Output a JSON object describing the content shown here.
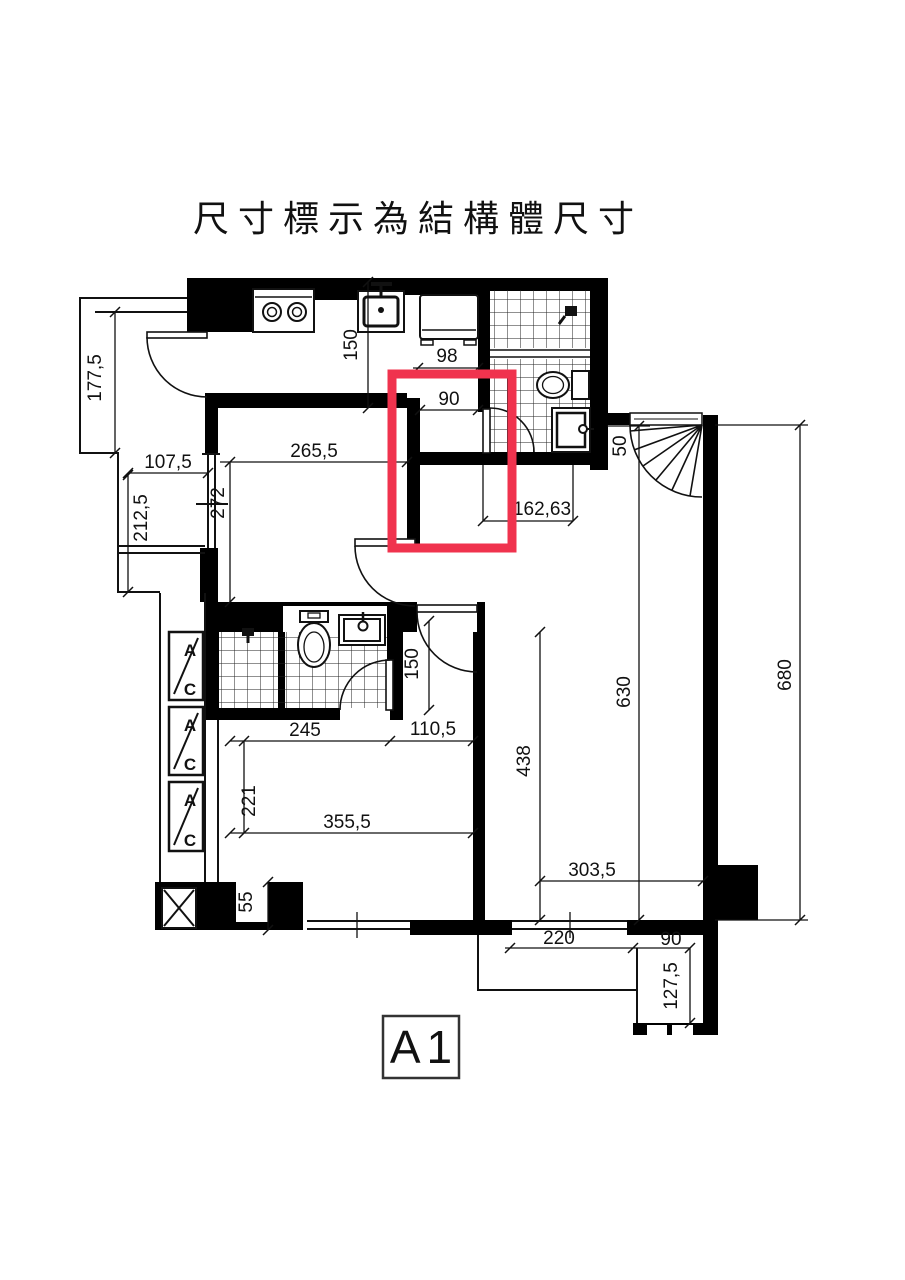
{
  "title": "尺寸標示為結構體尺寸",
  "plan": {
    "label": "A1",
    "highlight_color": "#f0334e"
  },
  "ac_unit": {
    "top": "A",
    "bottom": "C"
  },
  "dimensions": [
    {
      "name": "balcony-height",
      "text": "177,5"
    },
    {
      "name": "balcony-lower-width",
      "text": "107,5"
    },
    {
      "name": "balcony-lower-height",
      "text": "212,5"
    },
    {
      "name": "bedroom1-width",
      "text": "265,5"
    },
    {
      "name": "bedroom1-height",
      "text": "272"
    },
    {
      "name": "kitchen-counter",
      "text": "150"
    },
    {
      "name": "fridge-width",
      "text": "98"
    },
    {
      "name": "corridor-width",
      "text": "90"
    },
    {
      "name": "hall-width",
      "text": "162,63"
    },
    {
      "name": "entry-stub",
      "text": "50"
    },
    {
      "name": "living-height-inner",
      "text": "630"
    },
    {
      "name": "overall-height",
      "text": "680"
    },
    {
      "name": "door-clearance",
      "text": "150"
    },
    {
      "name": "bedroom2-upper-width",
      "text": "245"
    },
    {
      "name": "closet-width",
      "text": "110,5"
    },
    {
      "name": "bedroom2-upper-height",
      "text": "221"
    },
    {
      "name": "bedroom2-width",
      "text": "355,5"
    },
    {
      "name": "living-width",
      "text": "438"
    },
    {
      "name": "living-lower-width",
      "text": "303,5"
    },
    {
      "name": "wall-segment",
      "text": "55"
    },
    {
      "name": "balcony-bottom-width",
      "text": "220"
    },
    {
      "name": "balcony-bottom-depth",
      "text": "90"
    },
    {
      "name": "balcony-bottom-height",
      "text": "127,5"
    }
  ]
}
